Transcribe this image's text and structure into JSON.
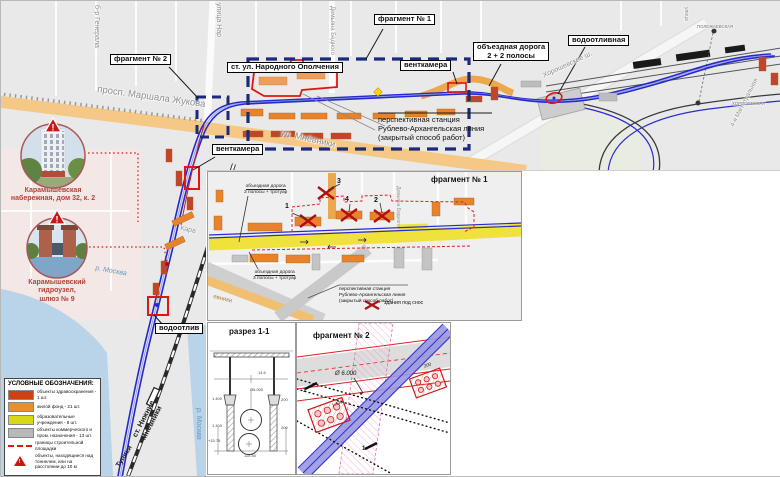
{
  "colors": {
    "navy_dash": "#1b2a7a",
    "highlight_red": "#e01515",
    "tunnel_blue": "#2828cc",
    "road_orange": "#f5c985",
    "bypass_yellow": "#f0e23c",
    "water_blue": "#b9d3e8",
    "legend_red": "#d04010",
    "legend_orange": "#e89030",
    "legend_yellow": "#d8d818",
    "legend_gray": "#b8b8b8"
  },
  "callouts": {
    "frag1": "фрагмент № 1",
    "frag2": "фрагмент № 2",
    "station": "ст. ул. Народного Ополчения",
    "vent_right": "венткамера",
    "vent_left": "венткамера",
    "bypass_line1": "объездная дорога",
    "bypass_line2": "2 + 2 полосы",
    "vodootlivnaya": "водоотливная",
    "vodootliv": "водоотлив"
  },
  "persp_station": [
    "перспективная станция",
    "Рублево-Архангельская линия",
    "(закрытый способ работ)"
  ],
  "photo_callouts": [
    {
      "caption": [
        "Карамышевская",
        "набережная, дом 32, к. 2"
      ]
    },
    {
      "caption": [
        "Карамышевский",
        "гидроузел,",
        "шлюз № 9"
      ]
    }
  ],
  "streets": {
    "zhukova": "просп. Маршала Жукова",
    "mnevniki": "ул. Мнёвники",
    "generala": "б-р Генерала",
    "narodnogo": "улица Нар",
    "bednogo": "Демьяна Бедного",
    "khoroshevskoe": "Хорошевское ш.",
    "magistralnaya": "4-я Магистральная",
    "ulitsa": "улица",
    "polezhaevskaya": "ПОЛЕЖАЕВСКАЯ",
    "khoroshevskaya": "ХОРОШЕВСКАЯ",
    "moskva_river": "р. Москва",
    "moskva_river2": "р. Москва",
    "nizhnie1": "ст. Нижние",
    "nizhnie2": "Мнёвники",
    "tupiki": "Тупики",
    "mnevniki_vert": "Мнёвники",
    "kara": "Кара"
  },
  "legend": {
    "title": "УСЛОВНЫЕ ОБОЗНАЧЕНИЯ:",
    "items": [
      {
        "type": "swatch",
        "color": "#d04010",
        "label": "объекты здравоохранения - 1 шт."
      },
      {
        "type": "swatch",
        "color": "#e89030",
        "label": "жилой фонд - 21 шт."
      },
      {
        "type": "swatch",
        "color": "#d8d818",
        "label": "образовательные учреждения - 8 шт."
      },
      {
        "type": "swatch",
        "color": "#b8b8b8",
        "label": "объекты коммерческого и пром. назначения - 13 шт."
      },
      {
        "type": "dash",
        "color": "#e01515",
        "label": "границы строительной площадки"
      },
      {
        "type": "triangle",
        "color": "#cc1515",
        "label": "объекты, находящиеся над тоннелем, или на расстоянии до 10 м"
      }
    ]
  },
  "inset1": {
    "title": "фрагмент № 1",
    "bypass_top": [
      "объездная дорога",
      "3 полосы + тротуар"
    ],
    "bypass_bottom": [
      "объездная дорога",
      "3 полосы + тротуар"
    ],
    "numbers": [
      "1",
      "2",
      "3",
      "4"
    ],
    "persp": [
      "перспективная станция",
      "Рублево-Архангельская линия",
      "(закрытый способ работ)"
    ],
    "demolition": "здания под снос",
    "street_right": "Демьяна Бедного",
    "street_bl": "евники"
  },
  "razrez": {
    "title": "разрез 1-1",
    "dims": [
      "14.6",
      "Ø6.000",
      "1.400",
      "200",
      "1.400",
      "200",
      "+15.75",
      "115.50"
    ]
  },
  "inset2": {
    "title": "фрагмент № 2",
    "diameter": "Ø 6.000",
    "dim200": "200",
    "dim1400": "1.400",
    "section_mark": "1"
  }
}
